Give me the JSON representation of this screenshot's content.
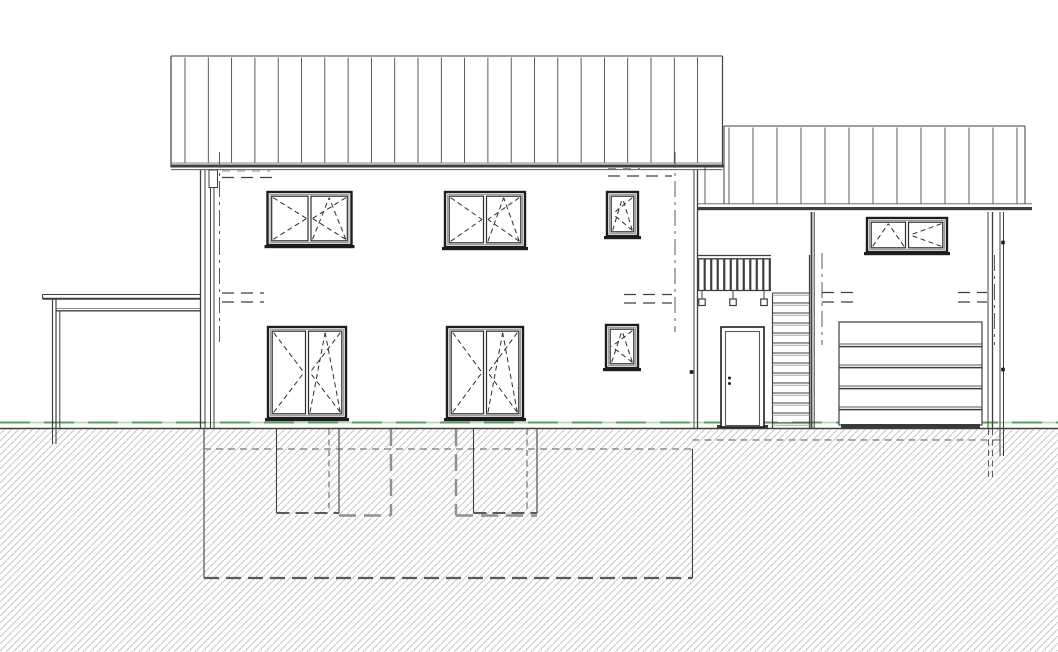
{
  "meta": {
    "description": "Architectural elevation drawing: two-storey house with carport (left), exterior entrance stair with railing, and garage wing (right); basement, foundations and light wells shown dashed below grade"
  },
  "canvas": {
    "width": 1058,
    "height": 652,
    "background": "#ffffff"
  },
  "colors": {
    "line": "#3f3f3f",
    "dark": "#1d1d1d",
    "mid": "#5a5a5a",
    "light": "#8f8f8f",
    "faint": "#aaaaaa",
    "hatch": "#c9c5c0",
    "green": "#55a355",
    "green_light": "#b7d9b7",
    "fill_dark": "#3a3a3a",
    "white": "#ffffff",
    "frame_inner": "#949494",
    "symbol": "#2e2e2e"
  },
  "ground": {
    "grade_y": 422.5,
    "terrain_y": 428.5,
    "hatch_top": 429.5
  },
  "roofs": {
    "main": {
      "x1": 171,
      "x2": 722.5,
      "top": 56,
      "eave": 163,
      "band_y": 164.5,
      "band_h": 3,
      "underline_y": 169.6,
      "seam_start": 185,
      "seam_step": 23.3,
      "seam_end": 716
    },
    "annex": {
      "x1": 724,
      "x2": 1025,
      "top": 126,
      "eave": 203.8,
      "left_ext": 697.5,
      "left_ext_top": 167.5,
      "fascia_x1": 697,
      "fascia_x2": 1032,
      "band_y": 207,
      "band_h": 3.2,
      "seam_start": 705,
      "seam_step": 24,
      "seam_end": 1020
    }
  },
  "walls": [
    {
      "name": "main-wall-left-outer",
      "x": 200.5,
      "y1": 170,
      "y2": 428,
      "w": 1.3
    },
    {
      "name": "main-wall-left-inner",
      "x": 205,
      "y1": 170,
      "y2": 428,
      "w": 1
    },
    {
      "name": "downpipe-left-a",
      "x": 210.5,
      "y1": 188,
      "y2": 428,
      "w": 1
    },
    {
      "name": "downpipe-left-b",
      "x": 214,
      "y1": 188,
      "y2": 428,
      "w": 1
    },
    {
      "name": "main-wall-right-inner",
      "x": 694,
      "y1": 170,
      "y2": 428,
      "w": 1
    },
    {
      "name": "main-wall-right-outer",
      "x": 697.5,
      "y1": 170,
      "y2": 428,
      "w": 1.3
    },
    {
      "name": "bay-divider-a",
      "x": 811.5,
      "y1": 212,
      "y2": 428,
      "w": 1.8
    },
    {
      "name": "bay-divider-b",
      "x": 814.2,
      "y1": 212,
      "y2": 428,
      "w": 1
    },
    {
      "name": "garage-wall-right-inner",
      "x": 988,
      "y1": 212,
      "y2": 428,
      "w": 1
    },
    {
      "name": "garage-wall-right-outer",
      "x": 992.5,
      "y1": 212,
      "y2": 428,
      "w": 1.3
    },
    {
      "name": "downpipe-right-a",
      "x": 1000,
      "y1": 212,
      "y2": 428,
      "w": 1
    },
    {
      "name": "downpipe-right-b",
      "x": 1003.5,
      "y1": 212,
      "y2": 428,
      "w": 1
    }
  ],
  "windows": [
    {
      "name": "window-upper-left",
      "x": 267.5,
      "y": 192,
      "w": 84,
      "h": 53,
      "panes": [
        "turn-right",
        "turn-tilt-left"
      ]
    },
    {
      "name": "window-upper-mid",
      "x": 445,
      "y": 192,
      "w": 80,
      "h": 55,
      "panes": [
        "turn-right",
        "turn-tilt-left"
      ]
    },
    {
      "name": "window-upper-small",
      "x": 607,
      "y": 192,
      "w": 31,
      "h": 44,
      "panes": [
        "turn-tilt-left"
      ]
    },
    {
      "name": "window-ground-left",
      "x": 268,
      "y": 327,
      "w": 78,
      "h": 91,
      "panes": [
        "turn-right",
        "turn-tilt-left"
      ]
    },
    {
      "name": "window-ground-mid",
      "x": 447,
      "y": 327,
      "w": 76,
      "h": 91,
      "panes": [
        "turn-right",
        "turn-tilt-left"
      ]
    },
    {
      "name": "window-ground-small",
      "x": 606,
      "y": 325,
      "w": 32,
      "h": 43,
      "panes": [
        "turn-tilt-left"
      ]
    },
    {
      "name": "window-garage",
      "x": 867,
      "y": 218,
      "w": 80,
      "h": 34,
      "panes": [
        "turn-tilt-right",
        "turn-left"
      ]
    }
  ],
  "door": {
    "x": 721,
    "y": 327,
    "w": 43,
    "h": 100,
    "leaf_inset": 4.5,
    "handle_x": 729.5,
    "handle_y1": 378,
    "handle_y2": 383.5,
    "threshold": {
      "x": 717,
      "w": 51,
      "y": 425,
      "h": 3.5
    }
  },
  "garage_door": {
    "x": 839,
    "y": 322,
    "w": 143,
    "h": 103,
    "seams_y": [
      344,
      365,
      386,
      407
    ],
    "bottom_bar": {
      "x": 841,
      "y": 424,
      "w": 139,
      "h": 4
    }
  },
  "stairs": {
    "x1": 772.5,
    "x2": 809.5,
    "top_y": 293,
    "step": 10,
    "count": 14,
    "right_edge_y1": 255,
    "bottom_y": 428
  },
  "railing": {
    "x1": 697,
    "x2": 771,
    "top_y": 255.5,
    "top2_y": 258.8,
    "bot_y": 290.5,
    "baluster_top": 259,
    "baluster_bot": 290,
    "baluster_count": 12,
    "baluster_w": 2.2,
    "hangers": [
      702,
      733,
      764
    ],
    "hanger_stem_y2": 299,
    "hanger_size": 6.5
  },
  "carport": {
    "slab": {
      "x1": 42.5,
      "x2": 200.5,
      "top_y": 294.5,
      "bot_y": 298.7
    },
    "beam": {
      "x1": 56,
      "x2": 200.5,
      "y_light": 308.5,
      "y_dark": 310.8
    },
    "post": {
      "xa": 52.5,
      "xb": 56,
      "y1": 298.7,
      "y2": 429,
      "foot_y2": 444
    },
    "inner": {
      "x": 59.8,
      "y1": 310.8,
      "y2": 428
    }
  },
  "underground": {
    "top_y": 429,
    "basement": {
      "left_x": 204,
      "right_x": 692.5,
      "left_y1": 429,
      "right_y1": 449,
      "bottom_y": 578,
      "ceiling_dash_y": 449,
      "shallow_dash_y": 440,
      "shallow_x2": 1002
    },
    "footings": [
      {
        "name": "garage-wall-footing-a",
        "x": 988.5,
        "y1": 429,
        "y2": 479,
        "style": "fine"
      },
      {
        "name": "garage-wall-footing-b",
        "x": 992.5,
        "y1": 429,
        "y2": 479,
        "style": "fine"
      },
      {
        "name": "downpipe-right-below-a",
        "x": 1000,
        "y1": 429,
        "y2": 456,
        "style": "solid"
      },
      {
        "name": "downpipe-right-below-b",
        "x": 1003.5,
        "y1": 429,
        "y2": 456,
        "style": "solid"
      },
      {
        "name": "carport-post-footing-a",
        "x": 52.5,
        "y1": 429,
        "y2": 444,
        "style": "solid"
      },
      {
        "name": "carport-post-footing-b",
        "x": 56,
        "y1": 429,
        "y2": 444,
        "style": "solid"
      }
    ],
    "lightwells": [
      {
        "name": "lightwell-left",
        "solid_x1": 276.5,
        "solid_x2": 339,
        "fine_x": 329,
        "bottom_y": 513,
        "gray_x": 391,
        "gray_bx1": 339,
        "gray_bx2": 391,
        "gray_by": 515.5
      },
      {
        "name": "lightwell-mid",
        "solid_x1": 473.5,
        "solid_x2": 537,
        "fine_x": 527,
        "bottom_y": 513,
        "gray_x": 456,
        "gray_bx1": 456,
        "gray_bx2": 537,
        "gray_by": 515.5
      }
    ]
  },
  "annotations": {
    "axis_lines": [
      {
        "name": "axis-left",
        "x": 219.5,
        "y1": 152,
        "y2": 342
      },
      {
        "name": "axis-main-right",
        "x": 675,
        "y1": 152,
        "y2": 332
      },
      {
        "name": "axis-entrance",
        "x": 822,
        "y1": 253,
        "y2": 345
      },
      {
        "name": "axis-garage-right",
        "x": 994.5,
        "y1": 255,
        "y2": 345
      }
    ],
    "level_dashes": [
      {
        "x1": 222,
        "x2": 270,
        "y": 171,
        "tone": "light"
      },
      {
        "x1": 222,
        "x2": 276,
        "y": 177.5,
        "tone": "dark"
      },
      {
        "x1": 608,
        "x2": 640,
        "y": 168.5,
        "tone": "light"
      },
      {
        "x1": 608,
        "x2": 672,
        "y": 176,
        "tone": "dark"
      },
      {
        "x1": 222,
        "x2": 264,
        "y": 293,
        "tone": "dark"
      },
      {
        "x1": 222,
        "x2": 264,
        "y": 302,
        "tone": "dark"
      },
      {
        "x1": 624,
        "x2": 672,
        "y": 294.5,
        "tone": "dark"
      },
      {
        "x1": 624,
        "x2": 672,
        "y": 303,
        "tone": "dark"
      },
      {
        "x1": 822,
        "x2": 858,
        "y": 292.5,
        "tone": "dark"
      },
      {
        "x1": 822,
        "x2": 858,
        "y": 302,
        "tone": "dark"
      },
      {
        "x1": 958,
        "x2": 987,
        "y": 292.5,
        "tone": "dark"
      },
      {
        "x1": 958,
        "x2": 987,
        "y": 302,
        "tone": "dark"
      }
    ],
    "brackets": [
      {
        "name": "gutter-bracket-left",
        "type": "rect",
        "x": 209,
        "y": 170,
        "w": 8.5,
        "h": 17.5
      },
      {
        "name": "pipe-clamp-right-upper",
        "type": "dot",
        "x": 1003,
        "y": 242.5
      },
      {
        "name": "pipe-clamp-right-lower",
        "type": "dot",
        "x": 1003,
        "y": 369.5
      },
      {
        "name": "wall-tick-entrance",
        "type": "dot",
        "x": 691.5,
        "y": 372
      }
    ]
  }
}
